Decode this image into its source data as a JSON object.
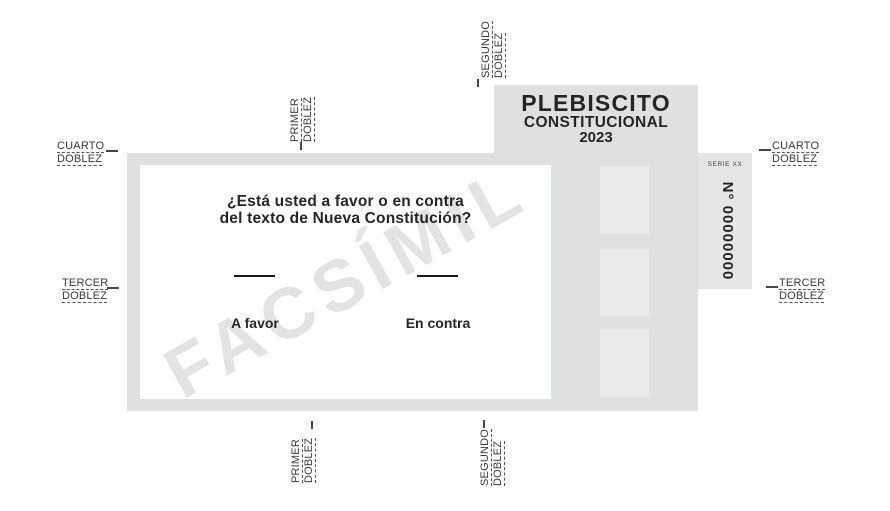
{
  "ballot": {
    "header": {
      "title": "PLEBISCITO",
      "subtitle": "CONSTITUCIONAL",
      "year": "2023"
    },
    "serial_panel": {
      "series": "SERIE XX",
      "number": "N° 00000000"
    },
    "question": {
      "line1": "¿Está usted a favor o en contra",
      "line2": "del texto de Nueva Constitución?"
    },
    "options": [
      {
        "label": "A favor"
      },
      {
        "label": "En contra"
      }
    ],
    "watermark": "FACSÍMIL"
  },
  "fold_labels": {
    "left_cuarto": {
      "line1": "CUARTO",
      "line2": "DOBLEZ"
    },
    "right_cuarto": {
      "line1": "CUARTO",
      "line2": "DOBLEZ"
    },
    "left_tercer": {
      "line1": "TERCER",
      "line2": "DOBLEZ"
    },
    "right_tercer": {
      "line1": "TERCER",
      "line2": "DOBLEZ"
    },
    "top_primer": {
      "line1": "PRIMER",
      "line2": "DOBLEZ"
    },
    "top_segundo": {
      "line1": "SEGUNDO",
      "line2": "DOBLEZ"
    },
    "bottom_primer": {
      "line1": "PRIMER",
      "line2": "DOBLEZ"
    },
    "bottom_segundo": {
      "line1": "SEGUNDO",
      "line2": "DOBLEZ"
    }
  },
  "colors": {
    "ballot_gray": "#dfe0e2",
    "panel_gray": "#e5e6e8",
    "square_gray": "#e9eaeb",
    "ink": "#252525",
    "label_ink": "#3a3a3a",
    "watermark": "#e3e3e5",
    "mark_line": "#1a1a1a"
  }
}
